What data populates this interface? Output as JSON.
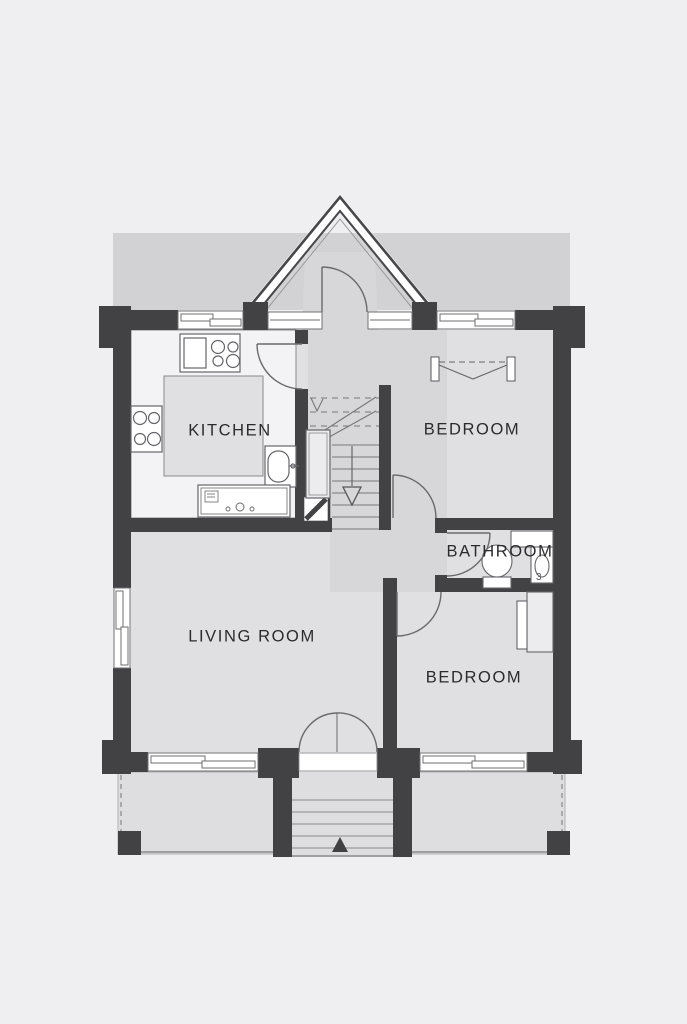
{
  "title": "house-floor-plan",
  "colors": {
    "page_bg": "#efeff1",
    "band": "#d2d2d4",
    "floor": "#e0e0e2",
    "hall_floor": "#d7d7d9",
    "porch": "#dedee0",
    "wall": "#424244",
    "counter": "#f3f3f5",
    "line": "#6a6a6d",
    "label": "#2b2b2d"
  },
  "rooms": {
    "kitchen": {
      "label": "KITCHEN"
    },
    "bedroom_top": {
      "label": "BEDROOM"
    },
    "bathroom": {
      "label": "BATHROOM"
    },
    "living_room": {
      "label": "LIVING ROOM"
    },
    "bedroom_bottom": {
      "label": "BEDROOM"
    }
  },
  "annotations": {
    "bathroom_mark": "3"
  },
  "fixtures": {
    "kitchen": [
      "stove",
      "hob",
      "sink",
      "dishwasher",
      "counters"
    ],
    "bathroom": [
      "toilet",
      "washbasin",
      "shelf"
    ],
    "bedroom_top": [
      "wardrobe-rail"
    ],
    "bedroom_bottom": [
      "wardrobe"
    ],
    "stairs": [
      "down-arrow",
      "under-stair-closet",
      "chimney"
    ],
    "porch": [
      "entry-steps",
      "up-arrow",
      "posts"
    ],
    "entry": [
      "gable-porch",
      "entry-door"
    ]
  }
}
